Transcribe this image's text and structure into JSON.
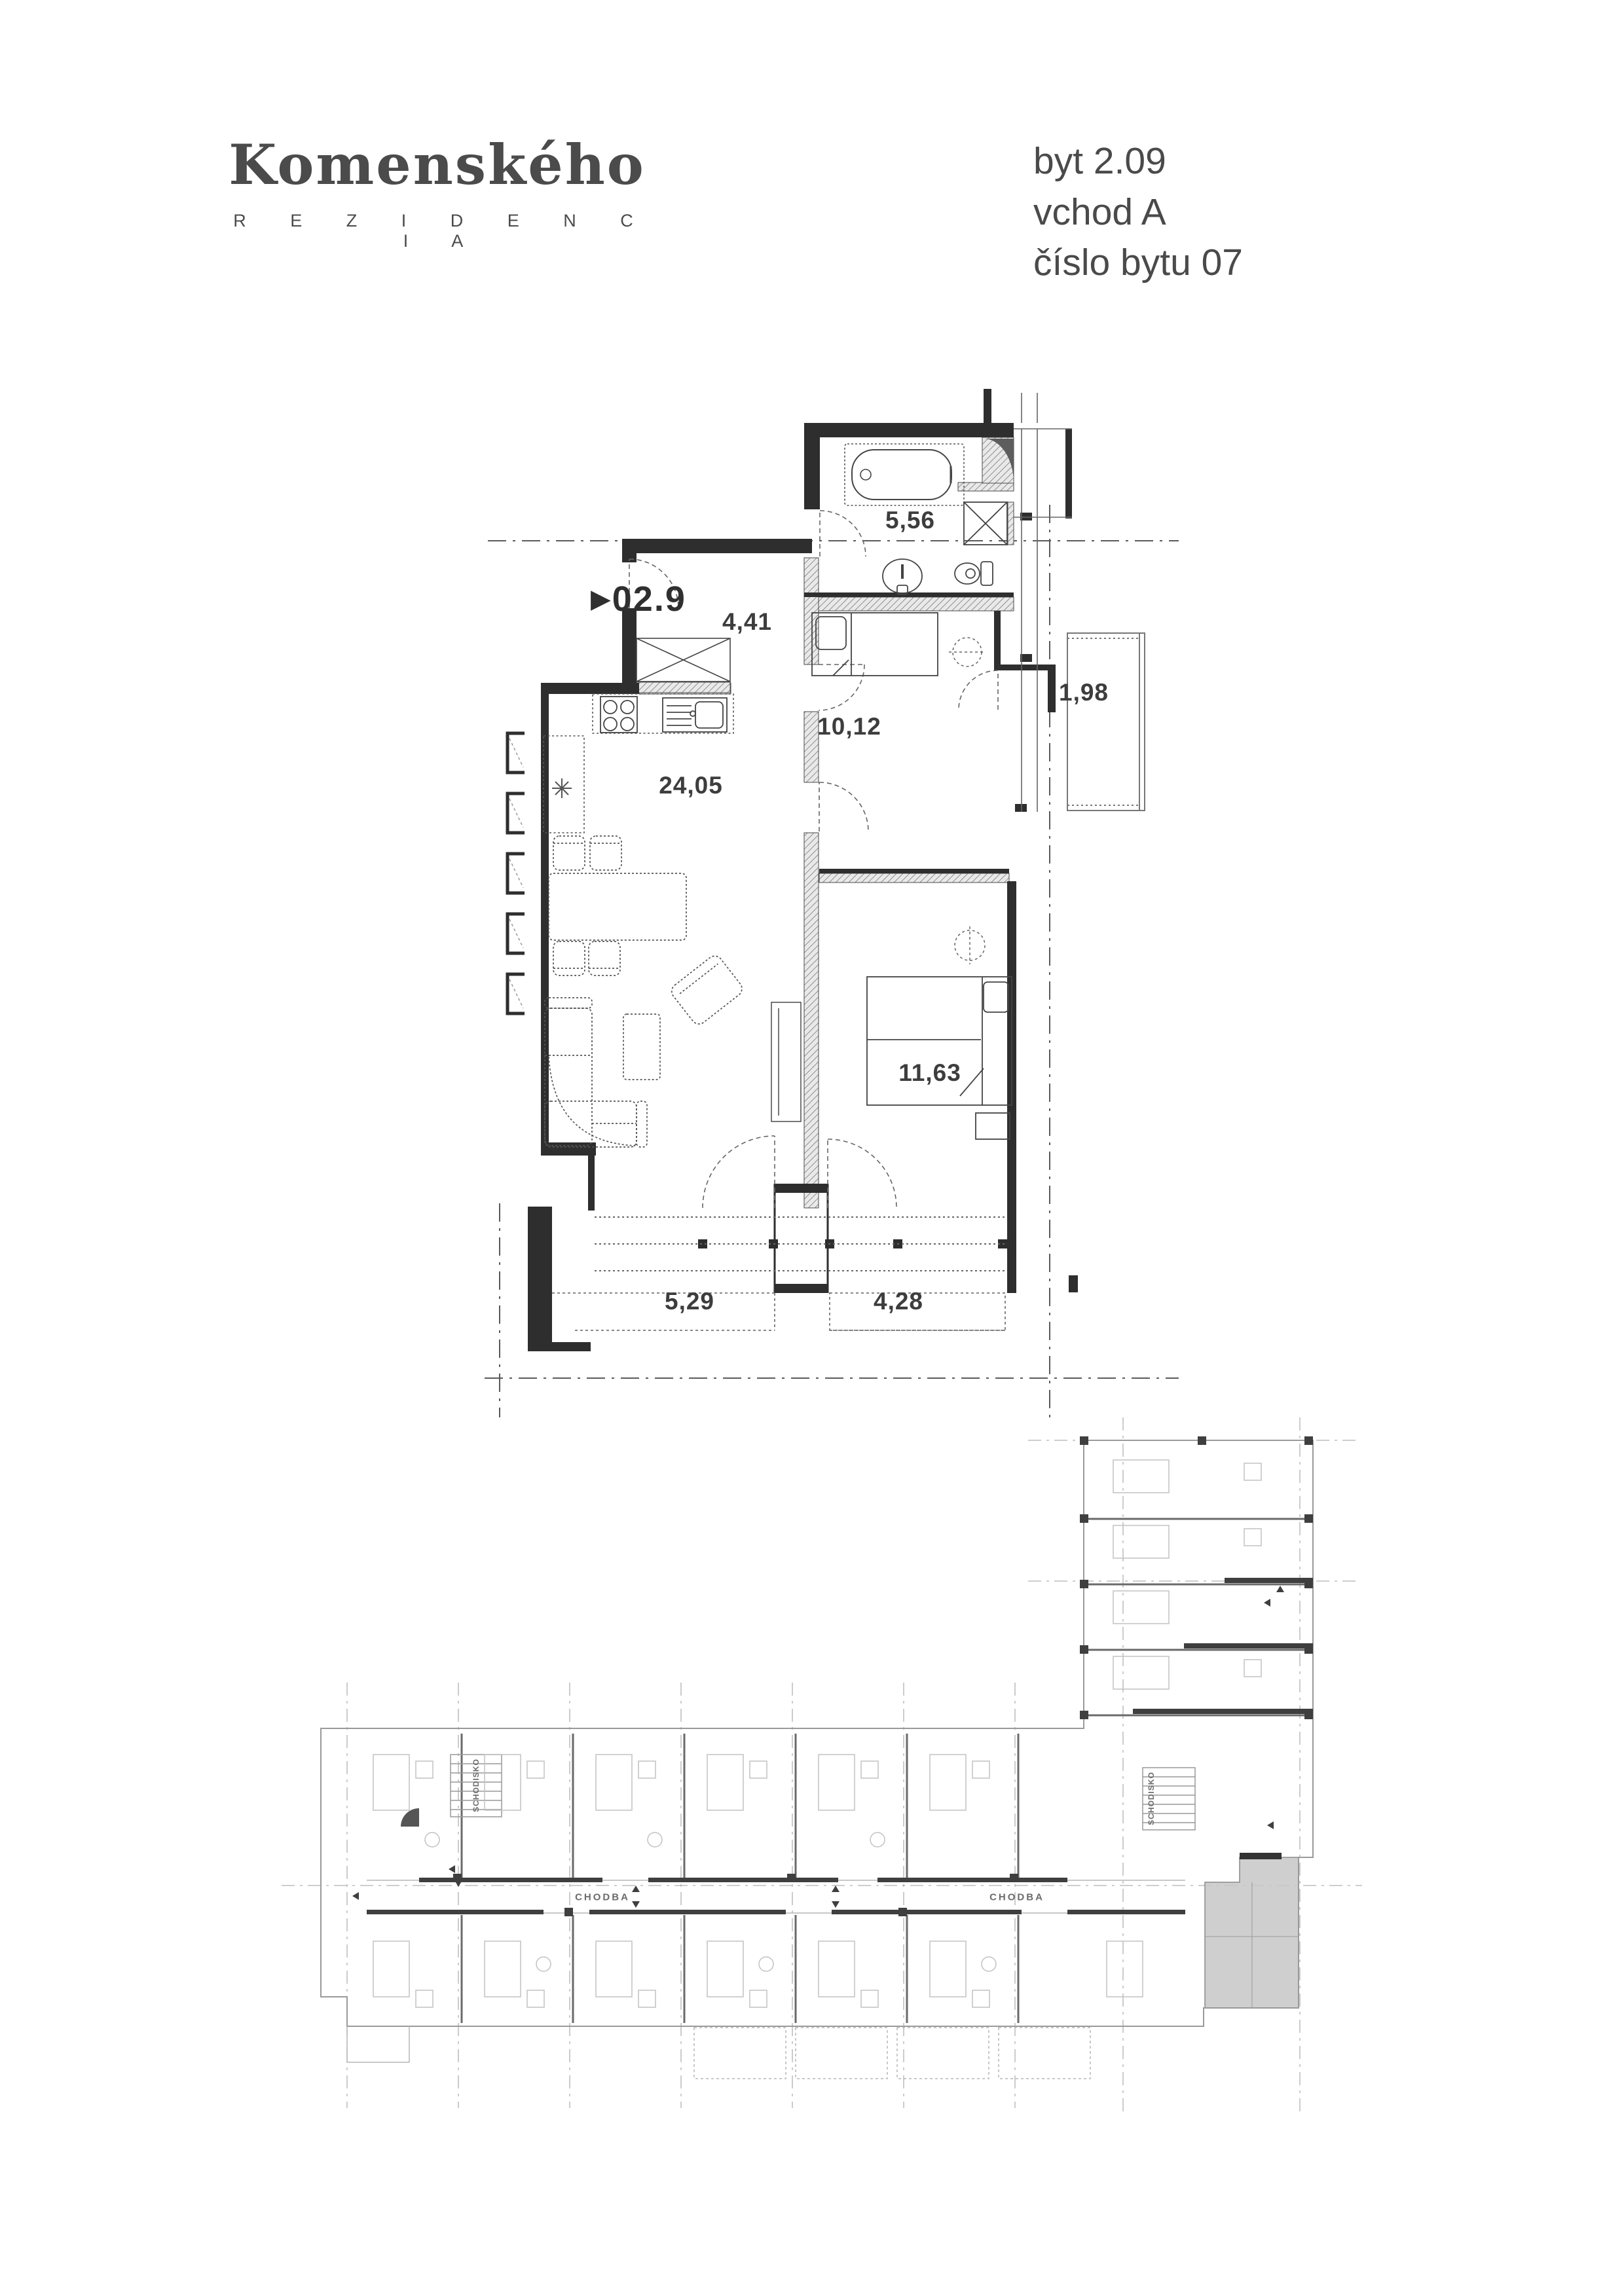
{
  "branding": {
    "logo_title": "Komenského",
    "logo_subtitle": "R E Z I D E N C I A"
  },
  "apartment_info": {
    "line1": "byt 2.09",
    "line2": "vchod A",
    "line3": "číslo bytu 07"
  },
  "main_plan": {
    "unit_marker": "▶",
    "unit_number": "02.9",
    "rooms": [
      {
        "id": "bathroom",
        "area": "5,56"
      },
      {
        "id": "hall",
        "area": "4,41"
      },
      {
        "id": "bedroom-1",
        "area": "10,12"
      },
      {
        "id": "balcony",
        "area": "1,98"
      },
      {
        "id": "living-kitchen",
        "area": "24,05"
      },
      {
        "id": "bedroom-2",
        "area": "11,63"
      },
      {
        "id": "terrace-1",
        "area": "5,29"
      },
      {
        "id": "terrace-2",
        "area": "4,28"
      }
    ]
  },
  "overview_plan": {
    "corridor_label_1": "CHODBA",
    "corridor_label_2": "CHODBA",
    "staircase_label_1": "SCHODISKO",
    "staircase_label_2": "SCHODISKO"
  },
  "colors": {
    "wall": "#2e2e2e",
    "line": "#555555",
    "light_line": "#a8a8a8",
    "highlight": "#c7c7c7",
    "text": "#3d3d3d"
  }
}
